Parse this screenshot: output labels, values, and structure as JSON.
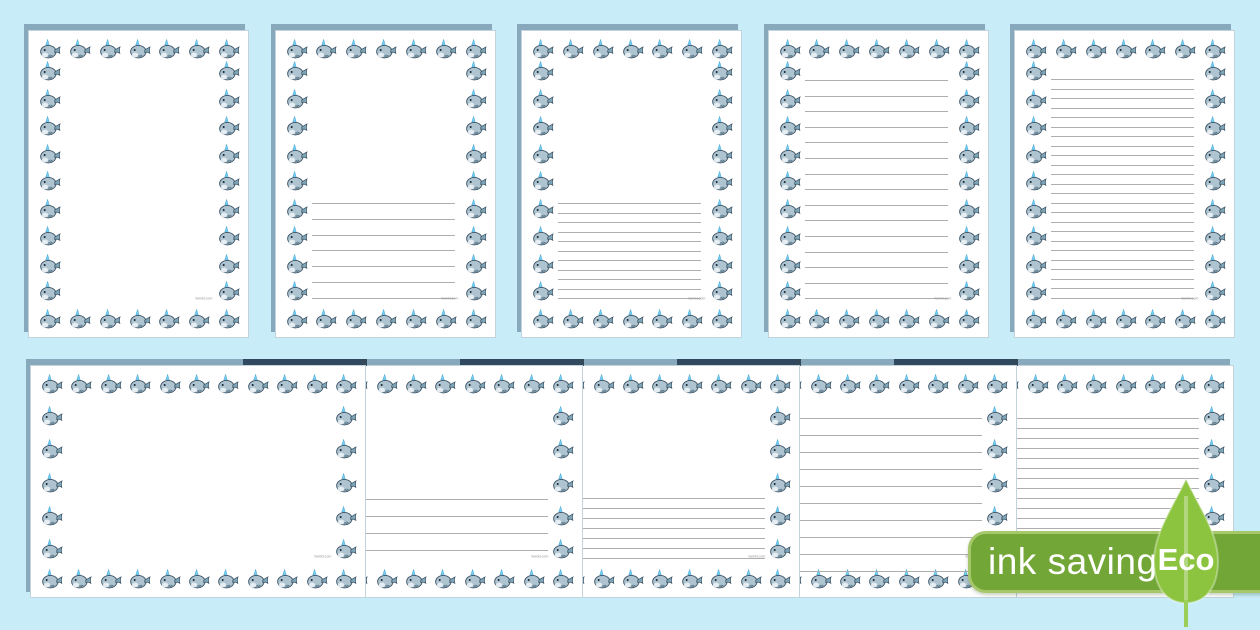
{
  "background_color": "#c9ecf9",
  "watermark": "twinkl.com",
  "badge": {
    "ink_saving_label": "ink saving",
    "eco_label": "Eco",
    "badge_color": "#72a637",
    "leaf_color": "#8cc43f"
  },
  "icons": {
    "narwhal": "narwhal-icon",
    "leaf": "eco-leaf-icon"
  },
  "pages": {
    "portrait_row": [
      {
        "id": "portrait-blank",
        "ruling": "blank",
        "line_count": 0
      },
      {
        "id": "portrait-half-page-wide-lines",
        "ruling": "half-page wide",
        "line_count": 7,
        "line_start": 172,
        "line_gap": 15.8
      },
      {
        "id": "portrait-half-page-narrow-lines",
        "ruling": "half-page narrow",
        "line_count": 11,
        "line_start": 172,
        "line_gap": 9.5
      },
      {
        "id": "portrait-full-page-wide-lines",
        "ruling": "full-page wide",
        "line_count": 15,
        "line_start": 49,
        "line_gap": 15.6
      },
      {
        "id": "portrait-full-page-narrow-lines",
        "ruling": "full-page narrow",
        "line_count": 24,
        "line_start": 48,
        "line_gap": 9.5
      }
    ],
    "landscape_row": [
      {
        "id": "landscape-blank",
        "ruling": "blank",
        "line_count": 0
      },
      {
        "id": "landscape-half-page-wide-lines",
        "ruling": "half-page wide",
        "line_count": 4,
        "line_start": 133,
        "line_gap": 17
      },
      {
        "id": "landscape-half-page-narrow-lines",
        "ruling": "half-page narrow",
        "line_count": 7,
        "line_start": 132,
        "line_gap": 10
      },
      {
        "id": "landscape-full-page-wide-lines",
        "ruling": "full-page wide",
        "line_count": 10,
        "line_start": 52,
        "line_gap": 17
      },
      {
        "id": "landscape-full-page-narrow-lines",
        "ruling": "full-page narrow",
        "line_count": 16,
        "line_start": 52,
        "line_gap": 10
      }
    ]
  }
}
